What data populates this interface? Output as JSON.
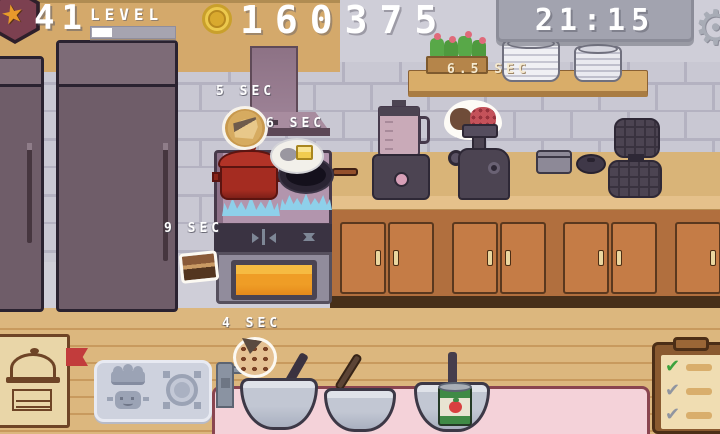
{
  "hud": {
    "level_value": "41",
    "level_label": "LEVEL",
    "score": "160375",
    "clock": "21:15"
  },
  "icons": {
    "star": "★",
    "gear": "⚙",
    "check": "✔"
  },
  "timers": {
    "cheese_plate": "5 SEC",
    "butter_plate": "6 SEC",
    "shelf_plates": "6.5 SEC",
    "chocolate": "9 SEC",
    "cookie_dough": "4 SEC"
  },
  "checklist": {
    "items": [
      {
        "glyph": "✔",
        "state": "done"
      },
      {
        "glyph": "✔",
        "state": "pending"
      },
      {
        "glyph": "✔",
        "state": "pending"
      }
    ]
  },
  "colors": {
    "accent_gold": "#ecc94e",
    "timer_panel_grey": "#a2a3af",
    "check_done_green": "#3da23d",
    "check_pending_grey": "#9095a0",
    "table_pink": "#f4d2d9",
    "counter_wood": "#b16f3e",
    "flame_blue": "#8ed0ea",
    "oven_glow_orange": "#ef9d26"
  }
}
